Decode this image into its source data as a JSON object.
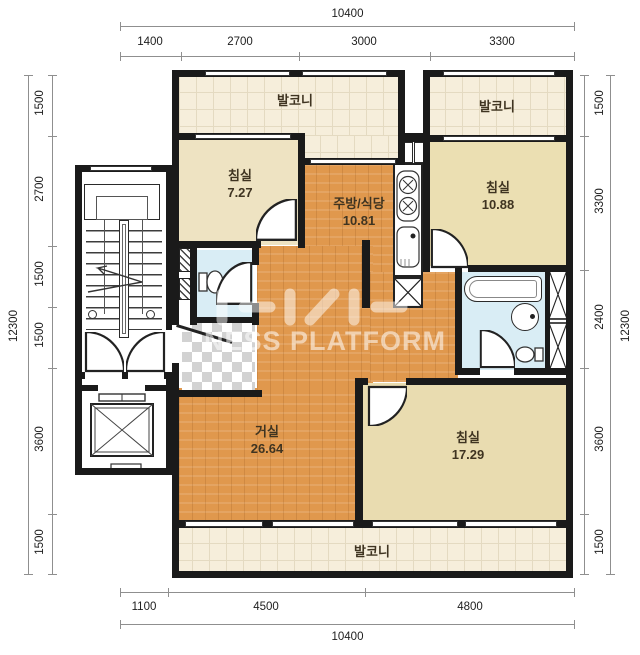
{
  "dims": {
    "top": {
      "total": "10400",
      "segments": [
        "1400",
        "2700",
        "3000",
        "3300"
      ]
    },
    "bottom": {
      "total": "10400",
      "segments": [
        "1100",
        "4500",
        "4800"
      ]
    },
    "left": {
      "total": "12300",
      "segments": [
        "1500",
        "2700",
        "1500",
        "1500",
        "3600",
        "1500"
      ]
    },
    "right": {
      "total": "12300",
      "segments": [
        "1500",
        "3300",
        "2400",
        "3600",
        "1500"
      ]
    }
  },
  "rooms": {
    "balcony_top_left": {
      "name": "발코니"
    },
    "balcony_top_right": {
      "name": "발코니"
    },
    "balcony_bottom": {
      "name": "발코니"
    },
    "bedroom_small": {
      "name": "침실",
      "area": "7.27"
    },
    "kitchen_dining": {
      "name": "주방/식당",
      "area": "10.81"
    },
    "bedroom_upper_right": {
      "name": "침실",
      "area": "10.88"
    },
    "living_room": {
      "name": "거실",
      "area": "26.64"
    },
    "bedroom_lower_right": {
      "name": "침실",
      "area": "17.29"
    }
  },
  "watermark": {
    "text": "NESS PLATFORM"
  },
  "colors": {
    "wall": "#1a1a1a",
    "wood_floor": "#e0984d",
    "tile_floor": "#f6eedb",
    "bedroom_floor": "#ecdfb6",
    "bathroom_floor": "#d9edf5",
    "dimension_text": "#1d1d1d"
  }
}
